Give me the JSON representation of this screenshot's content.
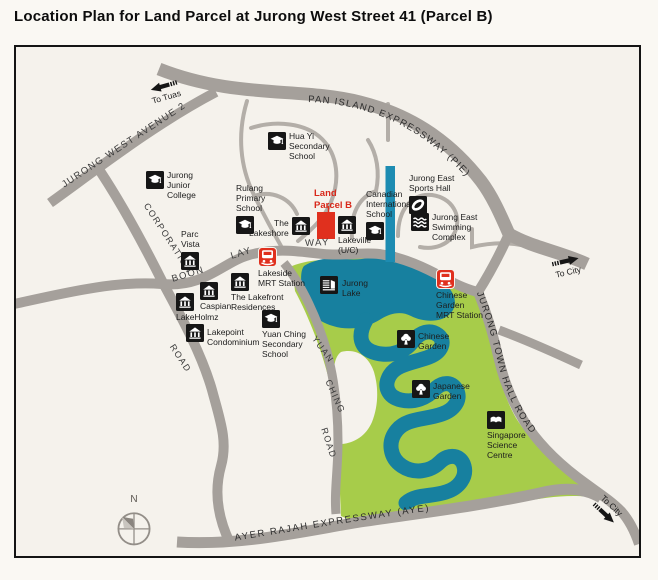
{
  "title": "Location Plan for Land Parcel at Jurong West Street 41 (Parcel B)",
  "compass": {
    "label": "N"
  },
  "parcel": {
    "label": "Land\nParcel B"
  },
  "directions": {
    "to_tuas": "To Tuas",
    "to_city": "To City"
  },
  "colors": {
    "land_parcel_red": "#e0301e",
    "park_green": "#a7cc4a",
    "water_teal": "#17809f",
    "canal_blue": "#1d8cb2",
    "road_grey": "#a5a09b",
    "map_background": "#f5f2ec"
  },
  "roads": {
    "pie": "PAN  ISLAND  EXPRESSWAY  (PIE)",
    "jurong_west_avenue_2": "JURONG WEST AVENUE 2",
    "corporation": "CORPORATION",
    "corporation_road": "ROAD",
    "boon": "BOON",
    "lay": "LAY",
    "way": "WAY",
    "yuan": "YUAN",
    "ching": "CHING",
    "yuan_ching_road": "ROAD",
    "jurong_town_hall_road": "JURONG  TOWN  HALL  ROAD",
    "ayer_rajah": "AYER  RAJAH  EXPRESSWAY  (AYE)"
  },
  "pois": [
    {
      "id": "hua-yi-secondary-school",
      "icon": "school-icon",
      "label": "Hua Yi\nSecondary\nSchool"
    },
    {
      "id": "jurong-junior-college",
      "icon": "school-icon",
      "label": "Jurong\nJunior\nCollege"
    },
    {
      "id": "rulang-primary-school",
      "icon": "school-icon",
      "label": "Rulang\nPrimary\nSchool"
    },
    {
      "id": "parc-vista",
      "icon": "condo-icon",
      "label": "Parc\nVista"
    },
    {
      "id": "the-lakeshore",
      "icon": "condo-icon",
      "label": "The\nLakeshore"
    },
    {
      "id": "lakeville",
      "icon": "condo-icon",
      "label": "Lakeville\n(U/C)"
    },
    {
      "id": "canadian-international-school",
      "icon": "school-icon",
      "label": "Canadian\nInternational\nSchool"
    },
    {
      "id": "jurong-east-sports-hall",
      "icon": "stadium-icon",
      "label": "Jurong East\nSports Hall"
    },
    {
      "id": "jurong-east-swimming-complex",
      "icon": "waves-icon",
      "label": "Jurong East\nSwimming\nComplex"
    },
    {
      "id": "lakeside-mrt-station",
      "icon": "mrt-icon",
      "label": "Lakeside\nMRT Station"
    },
    {
      "id": "jurong-lake",
      "icon": "lake-icon",
      "label": "Jurong\nLake"
    },
    {
      "id": "the-lakefront-residences",
      "icon": "condo-icon",
      "label": "The Lakefront\nResidences"
    },
    {
      "id": "caspian",
      "icon": "condo-icon",
      "label": "Caspian"
    },
    {
      "id": "lakeholmz",
      "icon": "condo-icon",
      "label": "LakeHolmz"
    },
    {
      "id": "lakepoint-condominium",
      "icon": "condo-icon",
      "label": "Lakepoint\nCondominium"
    },
    {
      "id": "yuan-ching-secondary-school",
      "icon": "school-icon",
      "label": "Yuan Ching\nSecondary\nSchool"
    },
    {
      "id": "chinese-garden-mrt-station",
      "icon": "mrt-icon",
      "label": "Chinese\nGarden\nMRT Station"
    },
    {
      "id": "chinese-garden",
      "icon": "tree-icon",
      "label": "Chinese\nGarden"
    },
    {
      "id": "japanese-garden",
      "icon": "tree-icon",
      "label": "Japanese\nGarden"
    },
    {
      "id": "singapore-science-centre",
      "icon": "science-icon",
      "label": "Singapore\nScience\nCentre"
    }
  ]
}
